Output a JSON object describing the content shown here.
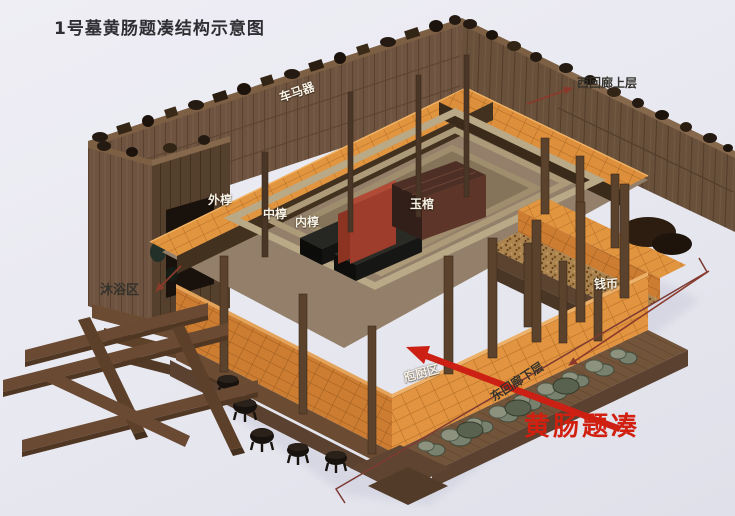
{
  "title": "1号墓黄肠题凑结构示意图",
  "diagram": {
    "type": "isometric cutaway schematic of Tomb No.1 huangchang-ticou timber structure",
    "labels": {
      "chariot_fittings": "车马器",
      "west_corridor_upper": "西回廊上层",
      "outer_coffin": "外椁",
      "middle_coffin": "中椁",
      "inner_coffin": "内椁",
      "jade_coffin": "玉棺",
      "bathing_area": "沐浴区",
      "coins": "钱币",
      "kitchen_area": "庖厨区",
      "east_corridor_lower": "东回廊下层",
      "huangchang_ticou": "黄肠题凑"
    },
    "colors": {
      "highlight_red": "#cc2014",
      "callout_maroon": "#8a3a2b",
      "bracket_line": "#7d3a33",
      "timber_orange": "#e2953f",
      "timber_orange_shaded": "#cd7d31",
      "wall_brown": "#6e5440",
      "platform_brown": "#6b4c33",
      "background": "#e9e9f1",
      "title_text": "#2f2f33",
      "label_light": "#f7f2e6",
      "label_dark": "#35322c"
    }
  }
}
